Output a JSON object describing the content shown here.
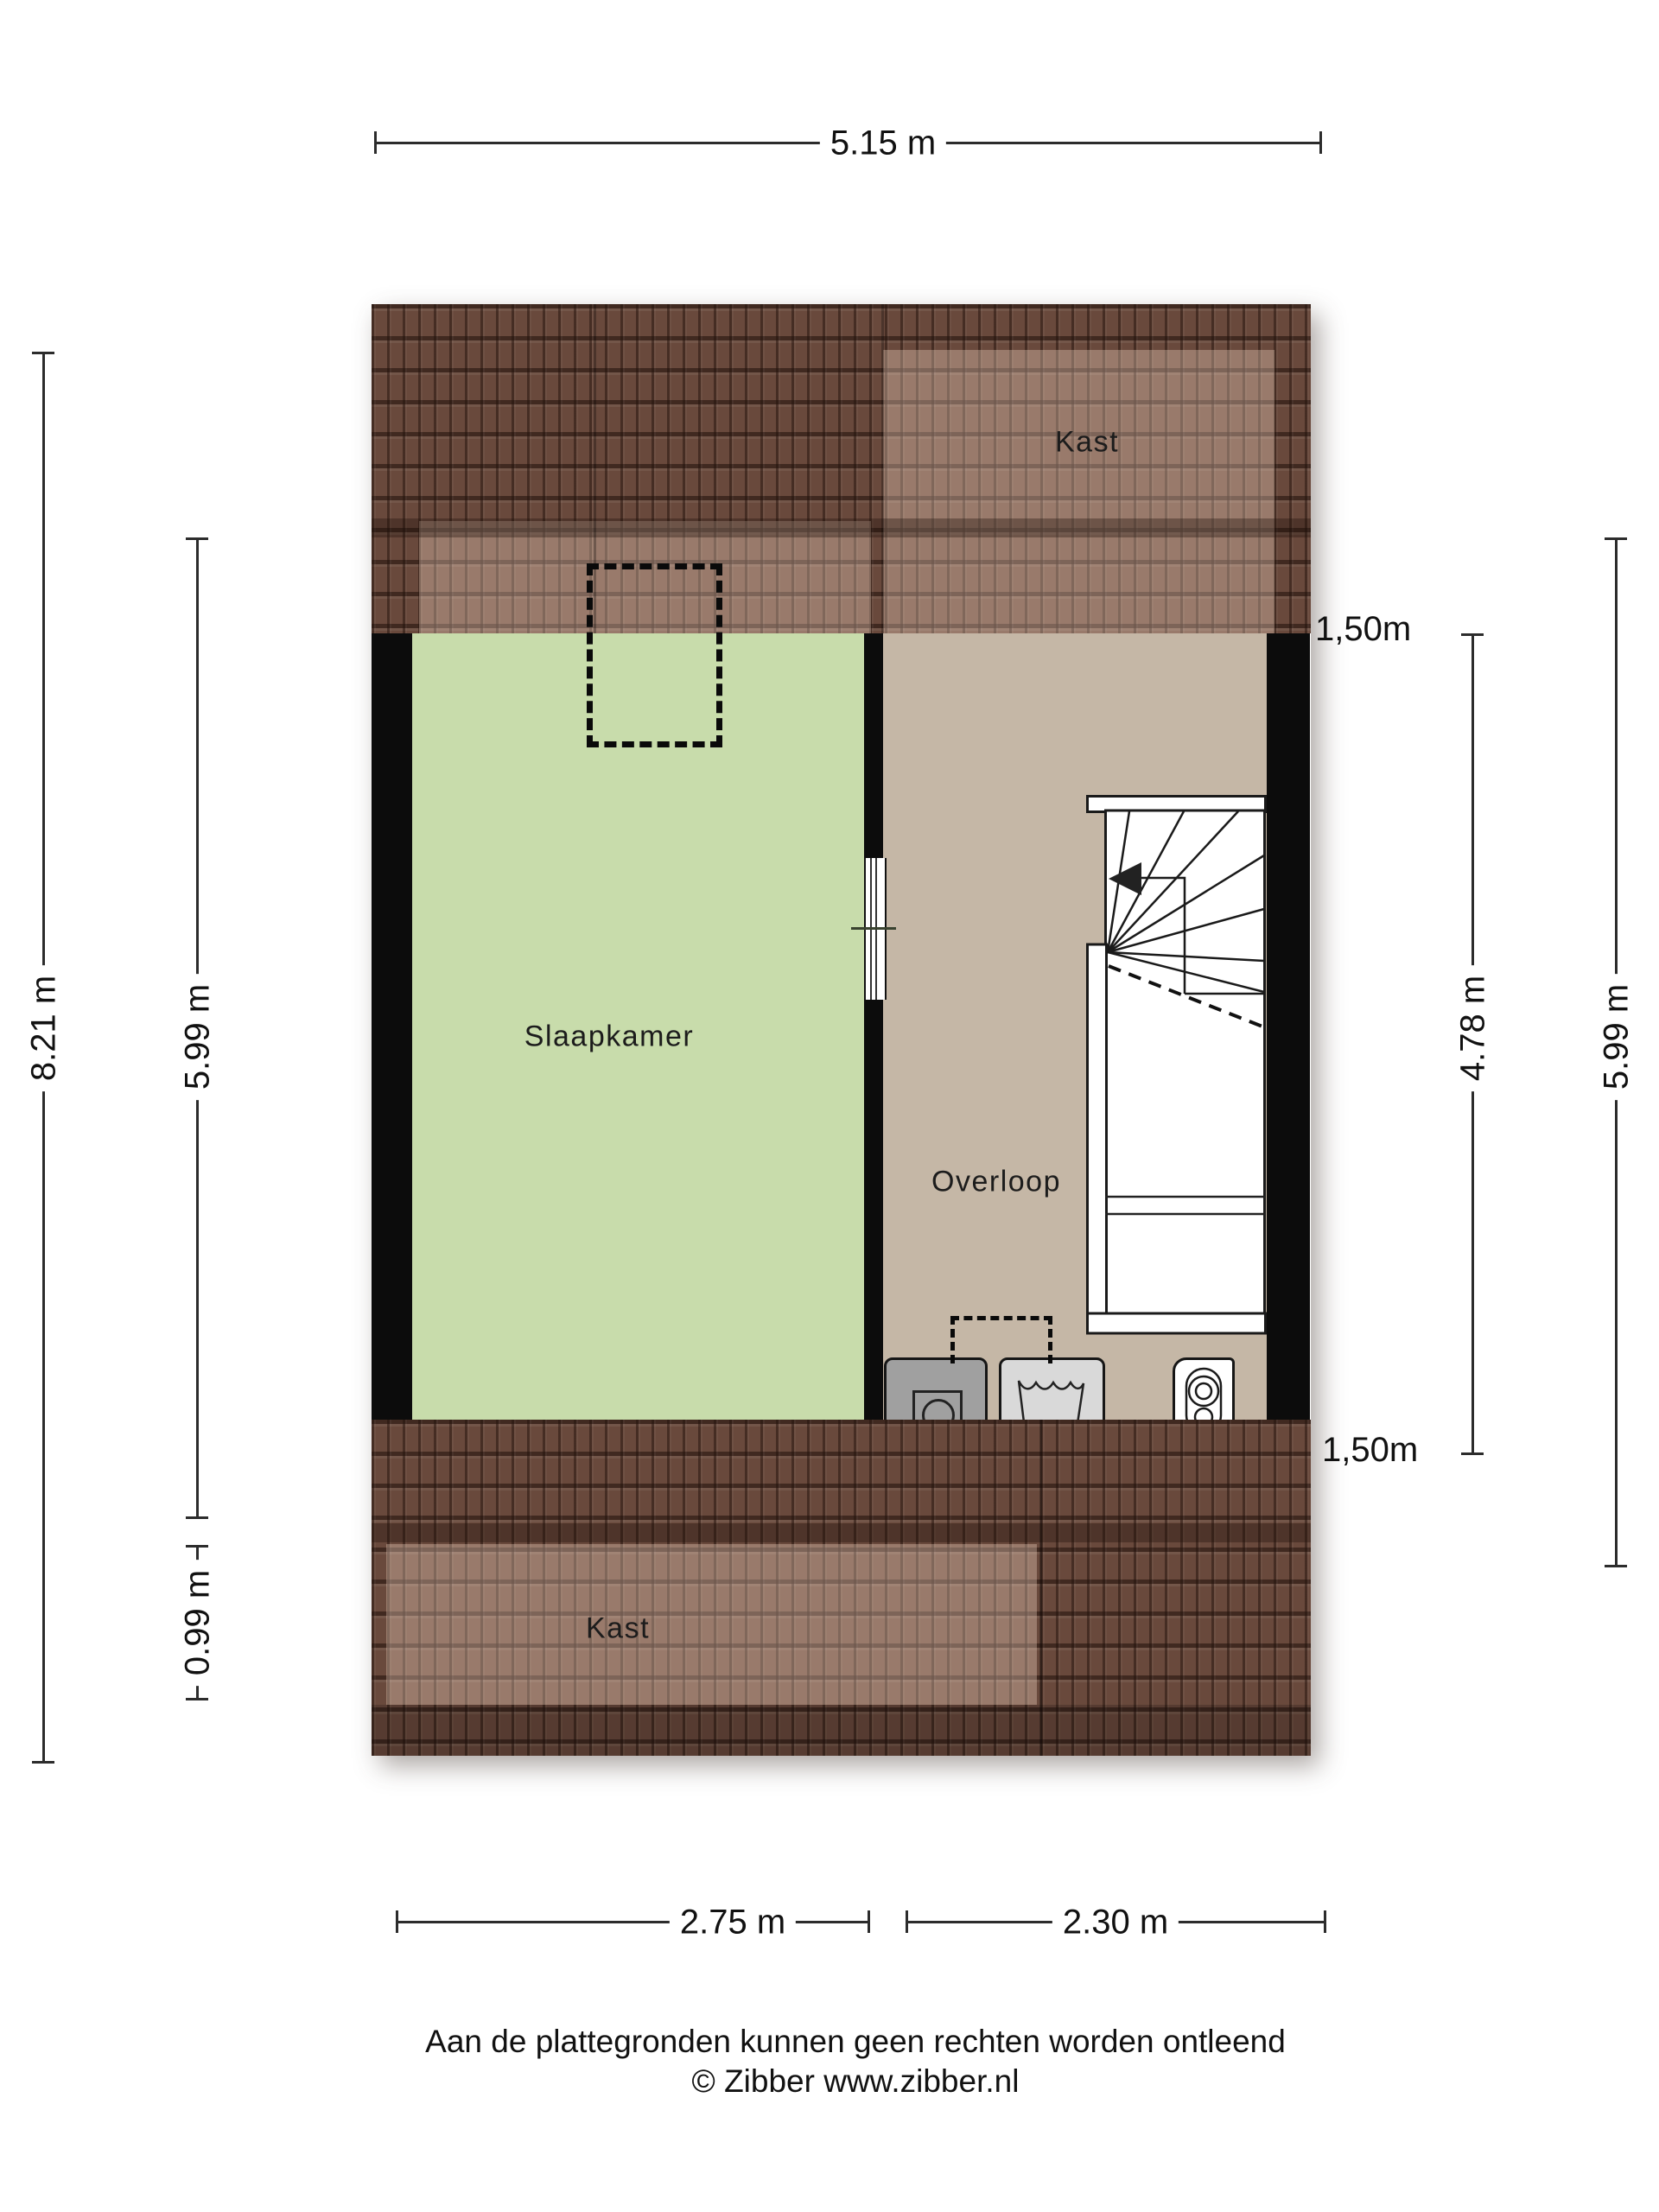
{
  "floor_plan": {
    "rooms": [
      {
        "name": "Slaapkamer"
      },
      {
        "name": "Overloop"
      }
    ],
    "closets": [
      {
        "name": "Kast",
        "position": "top"
      },
      {
        "name": "Kast",
        "position": "bottom"
      }
    ],
    "features": [
      "stairs",
      "dormer-outline",
      "dryer",
      "washing-machine",
      "boiler"
    ],
    "colors": {
      "bedroom_green": "#c8dcab",
      "landing_tan": "#c5b7a6",
      "roof_tile_brown": "#7d5a4b",
      "wall_black": "#0c0c0c"
    }
  },
  "dimensions": {
    "top_width": "5.15 m",
    "left_total_height": "8.21 m",
    "left_inner_height": "5.99 m",
    "left_lower": "0.99 m",
    "knee_wall_top": "1,50m",
    "knee_wall_bottom": "1,50m",
    "right_stair_height": "4.78 m",
    "right_inner_height": "5.99 m",
    "bottom_left_width": "2.75 m",
    "bottom_right_width": "2.30 m"
  },
  "footer": {
    "disclaimer": "Aan de plattegronden kunnen geen rechten worden ontleend",
    "copyright": "© Zibber www.zibber.nl"
  }
}
